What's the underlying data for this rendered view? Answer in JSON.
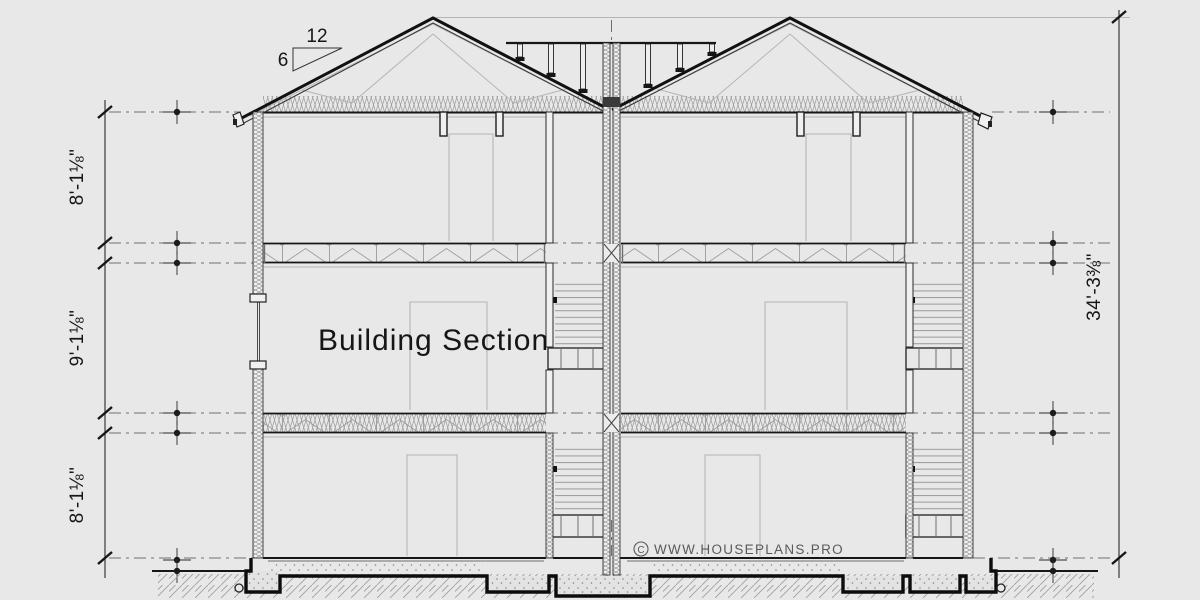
{
  "drawing": {
    "title": "Building Section",
    "watermark": {
      "symbol": "C",
      "text": "WWW.HOUSEPLANS.PRO"
    },
    "roof_pitch": {
      "run": "12",
      "rise": "6"
    },
    "dimensions": {
      "left_floor_heights": [
        "8'-1⅛\"",
        "9'-1⅛\"",
        "8'-1⅛\""
      ],
      "overall_height": "34'-3⅜\""
    },
    "colors": {
      "background": "#e8e8e8",
      "ink": "#161616",
      "mid": "#6f6f6f",
      "light": "#b5b5b5",
      "hatch": "#9a9a9a",
      "watermark": "#5a5a5a"
    }
  }
}
